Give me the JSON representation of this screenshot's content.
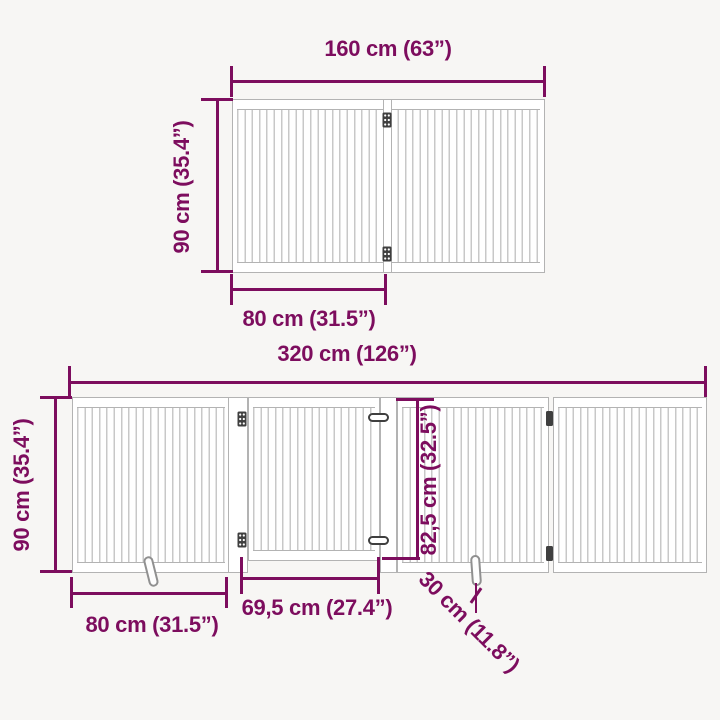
{
  "colors": {
    "accent": "#7d0d5e",
    "background": "#f7f6f4",
    "gate_outline": "#b3b3b3",
    "slat": "#c8c8c8",
    "hardware": "#3f3f3f"
  },
  "top_gate": {
    "width": "160 cm (63”)",
    "height": "90 cm (35.4”)",
    "panel_width": "80 cm (31.5”)"
  },
  "bottom_gate": {
    "total_width": "320 cm (126”)",
    "height": "90 cm (35.4”)",
    "panel_width": "80 cm (31.5”)",
    "door_width": "69,5 cm (27.4”)",
    "door_height": "82,5 cm (32.5”)",
    "foot_size": "30 cm (11.8”)"
  },
  "icons": {
    "hinge": "hinge-icon",
    "latch": "latch-icon",
    "foot": "support-foot-icon"
  }
}
